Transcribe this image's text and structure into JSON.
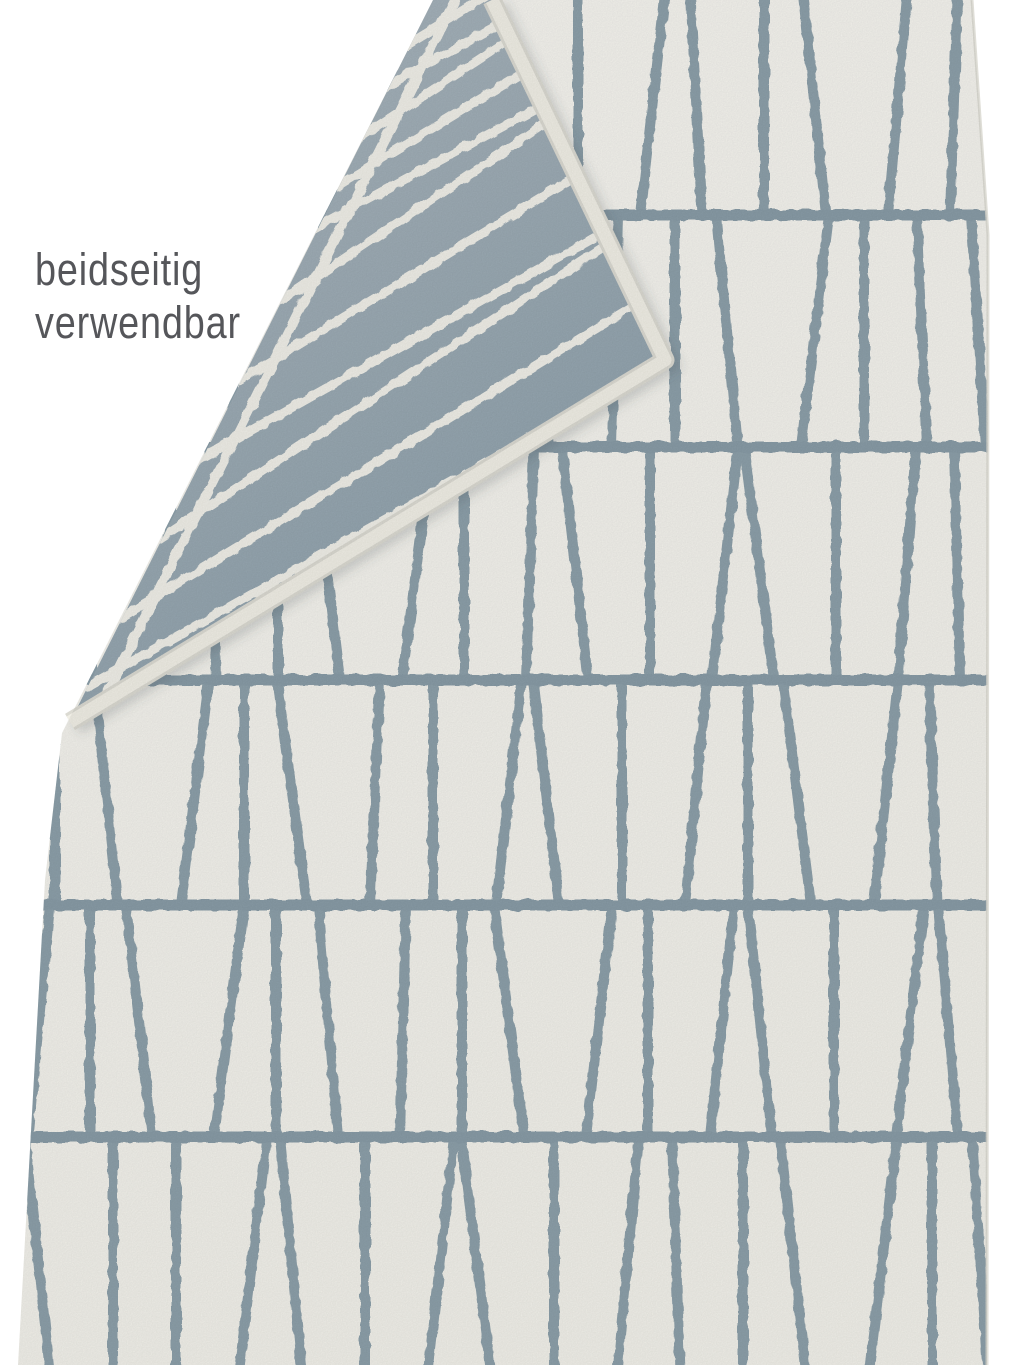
{
  "page": {
    "width": 1024,
    "height": 1365,
    "background": "#ffffff"
  },
  "annotation": {
    "line1": "beidseitig",
    "line2": "verwendbar",
    "color": "#55565a"
  },
  "colors": {
    "front_base": "#f2f1ea",
    "front_base_bright": "#f6f5f0",
    "front_line": "#8da0aa",
    "separator_line": "#899ca7",
    "flap_light": "#abb7bf",
    "flap_dark": "#8da0ab",
    "flap_line": "#f0efe8",
    "binding": "#f1efe6",
    "binding_rim": "#dbdad2",
    "edge_shade": "#d9d8d0",
    "shadow": "rgba(70,80,88,0.20)"
  },
  "geometry": {
    "front_outline": [
      [
        433,
        0
      ],
      [
        972,
        0
      ],
      [
        988,
        235
      ],
      [
        987,
        1365
      ],
      [
        18,
        1365
      ],
      [
        45,
        880
      ],
      [
        62,
        733
      ]
    ],
    "right_edge": [
      [
        972,
        0
      ],
      [
        988,
        235
      ],
      [
        987,
        1365
      ]
    ],
    "flap_quad": [
      [
        433,
        0
      ],
      [
        492,
        0
      ],
      [
        665,
        360
      ],
      [
        70,
        722
      ]
    ],
    "binding_path": [
      [
        492,
        0
      ],
      [
        665,
        360
      ],
      [
        70,
        722
      ]
    ],
    "shadow_offset": [
      7,
      5
    ]
  },
  "pattern": {
    "line_width": 10,
    "separator_width": 11,
    "separators_y": [
      215,
      447,
      680,
      905,
      1137
    ],
    "rows": [
      {
        "top": -15,
        "bottom": 215,
        "lines": [
          [
            25,
            20
          ],
          [
            64,
            82
          ],
          [
            168,
            144
          ],
          [
            206,
            206
          ],
          [
            242,
            268
          ],
          [
            350,
            330
          ],
          [
            392,
            392
          ],
          [
            478,
            454
          ],
          [
            494,
            516
          ],
          [
            578,
            578
          ],
          [
            666,
            640
          ],
          [
            690,
            702
          ],
          [
            764,
            764
          ],
          [
            802,
            826
          ],
          [
            908,
            888
          ],
          [
            958,
            950
          ]
        ]
      },
      {
        "top": 215,
        "bottom": 447,
        "lines": [
          [
            45,
            45
          ],
          [
            130,
            108
          ],
          [
            143,
            171
          ],
          [
            234,
            234
          ],
          [
            323,
            297
          ],
          [
            352,
            360
          ],
          [
            423,
            423
          ],
          [
            516,
            486
          ],
          [
            525,
            549
          ],
          [
            618,
            612
          ],
          [
            675,
            675
          ],
          [
            716,
            738
          ],
          [
            829,
            801
          ],
          [
            864,
            864
          ],
          [
            917,
            927
          ],
          [
            971,
            985
          ]
        ]
      },
      {
        "top": 447,
        "bottom": 680,
        "lines": [
          [
            6,
            30
          ],
          [
            92,
            92
          ],
          [
            178,
            154
          ],
          [
            210,
            216
          ],
          [
            278,
            278
          ],
          [
            312,
            340
          ],
          [
            432,
            402
          ],
          [
            464,
            464
          ],
          [
            534,
            526
          ],
          [
            562,
            588
          ],
          [
            650,
            650
          ],
          [
            738,
            712
          ],
          [
            744,
            774
          ],
          [
            836,
            836
          ],
          [
            916,
            898
          ],
          [
            954,
            960
          ]
        ]
      },
      {
        "top": 680,
        "bottom": 905,
        "lines": [
          [
            55,
            55
          ],
          [
            94,
            118
          ],
          [
            209,
            181
          ],
          [
            244,
            244
          ],
          [
            277,
            307
          ],
          [
            380,
            370
          ],
          [
            433,
            433
          ],
          [
            522,
            496
          ],
          [
            533,
            559
          ],
          [
            622,
            622
          ],
          [
            707,
            685
          ],
          [
            748,
            748
          ],
          [
            783,
            811
          ],
          [
            898,
            874
          ],
          [
            929,
            937
          ]
        ]
      },
      {
        "top": 905,
        "bottom": 1137,
        "lines": [
          [
            50,
            28
          ],
          [
            90,
            90
          ],
          [
            126,
            152
          ],
          [
            244,
            214
          ],
          [
            276,
            276
          ],
          [
            318,
            338
          ],
          [
            406,
            400
          ],
          [
            462,
            462
          ],
          [
            494,
            524
          ],
          [
            612,
            586
          ],
          [
            648,
            648
          ],
          [
            734,
            710
          ],
          [
            748,
            772
          ],
          [
            834,
            834
          ],
          [
            924,
            896
          ],
          [
            938,
            958
          ]
        ]
      },
      {
        "top": 1137,
        "bottom": 1372,
        "lines": [
          [
            25,
            50
          ],
          [
            113,
            113
          ],
          [
            176,
            176
          ],
          [
            267,
            239
          ],
          [
            280,
            302
          ],
          [
            365,
            365
          ],
          [
            454,
            428
          ],
          [
            461,
            491
          ],
          [
            554,
            554
          ],
          [
            639,
            617
          ],
          [
            672,
            680
          ],
          [
            743,
            743
          ],
          [
            780,
            806
          ],
          [
            897,
            869
          ],
          [
            932,
            932
          ],
          [
            972,
            988
          ]
        ]
      }
    ],
    "flap": {
      "bar_width": 9,
      "bar_positions": [
        46,
        94,
        150,
        206,
        252,
        336,
        424,
        512,
        600,
        690,
        768
      ],
      "bar_angles_deg": [
        0,
        2.5,
        -2,
        0,
        3,
        -2.5,
        0,
        2,
        -2,
        0,
        2
      ],
      "edge_separator_offset": 20,
      "edge_separator_width": 10
    }
  }
}
